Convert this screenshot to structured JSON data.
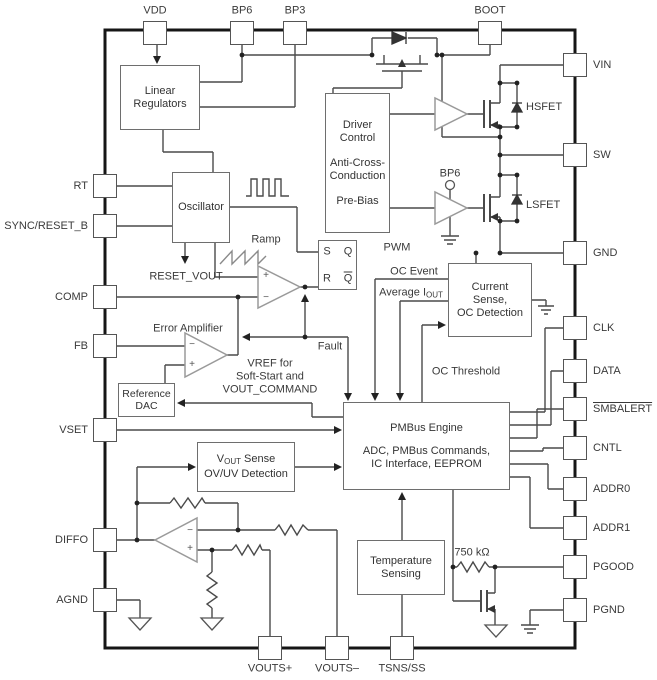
{
  "pins": {
    "top": [
      "VDD",
      "BP6",
      "BP3",
      "BOOT"
    ],
    "left": [
      "RT",
      "SYNC/RESET_B",
      "COMP",
      "FB",
      "VSET",
      "DIFFO",
      "AGND"
    ],
    "right": [
      "VIN",
      "SW",
      "GND",
      "CLK",
      "DATA",
      "SMBALERT",
      "CNTL",
      "ADDR0",
      "ADDR1",
      "PGOOD",
      "PGND"
    ],
    "bottom": [
      "VOUTS+",
      "VOUTS–",
      "TSNS/SS"
    ]
  },
  "blocks": {
    "linear_regulators": [
      "Linear",
      "Regulators"
    ],
    "oscillator": "Oscillator",
    "driver_control": [
      "Driver",
      "Control",
      "Anti-Cross-",
      "Conduction",
      "Pre-Bias"
    ],
    "sr_latch": {
      "s": "S",
      "q": "Q",
      "r": "R",
      "qbar": "Q"
    },
    "current_sense": [
      "Current",
      "Sense,",
      "OC Detection"
    ],
    "pmbus": {
      "title": "PMBus Engine",
      "line1": "ADC, PMBus Commands,",
      "line2": "IC Interface, EEPROM"
    },
    "reference_dac": [
      "Reference",
      "DAC"
    ],
    "vout_sense": {
      "v": "V",
      "sub": "OUT",
      "rest": "Sense",
      "line2": "OV/UV Detection"
    },
    "temperature": [
      "Temperature",
      "Sensing"
    ]
  },
  "labels": {
    "error_amplifier": "Error Amplifier",
    "reset_vout": "RESET_VOUT",
    "ramp": "Ramp",
    "pwm": "PWM",
    "oc_event": "OC Event",
    "average_prefix": "Average I",
    "average_sub": "OUT",
    "fault": "Fault",
    "oc_threshold": "OC Threshold",
    "vref": [
      "VREF for",
      "Soft-Start and",
      "VOUT_COMMAND"
    ],
    "hsfet": "HSFET",
    "lsfet": "LSFET",
    "bp6_internal": "BP6",
    "r750": "750 kΩ",
    "plus": "+",
    "minus": "−"
  },
  "colors": {
    "wire": "#4a4a4a",
    "block_border": "#6e6e6e",
    "chip_border": "#161616",
    "text": "#333333",
    "amp_stroke": "#9a9a9a"
  }
}
